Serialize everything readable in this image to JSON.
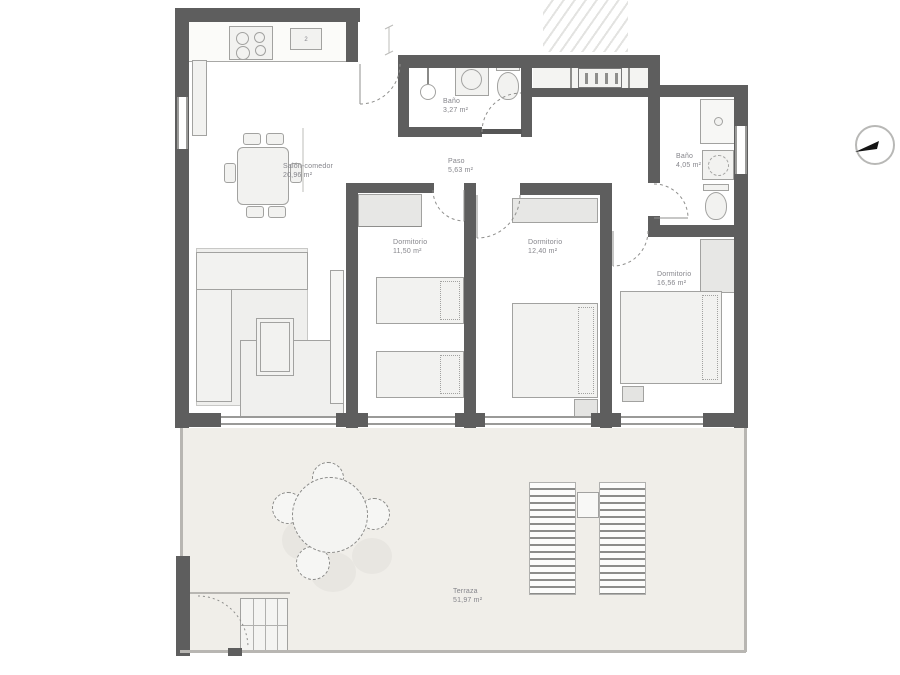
{
  "rooms": {
    "salon": {
      "label": "Salón-comedor",
      "area": "20,96 m²"
    },
    "banyo_top": {
      "label": "Baño",
      "area": "3,27 m²"
    },
    "paso": {
      "label": "Paso",
      "area": "5,63 m²"
    },
    "dorm1": {
      "label": "Dormitorio",
      "area": "11,50 m²"
    },
    "dorm2": {
      "label": "Dormitorio",
      "area": "12,40 m²"
    },
    "banyo_right": {
      "label": "Baño",
      "area": "4,05 m²"
    },
    "dorm3": {
      "label": "Dormitorio",
      "area": "16,56 m²"
    },
    "terraza": {
      "label": "Terraza",
      "area": "51,97 m²"
    }
  },
  "kitchen": {
    "appliance_label": "2"
  },
  "icons": {
    "compass_icon": "north-arrow-in-circle"
  },
  "colors": {
    "wall": "#5e5e5e",
    "furniture_outline": "#a2a2a0",
    "furniture_fill": "#f2f2f0",
    "terrace_floor": "#f0eee9",
    "label_text": "#85858b",
    "background": "#ffffff"
  }
}
